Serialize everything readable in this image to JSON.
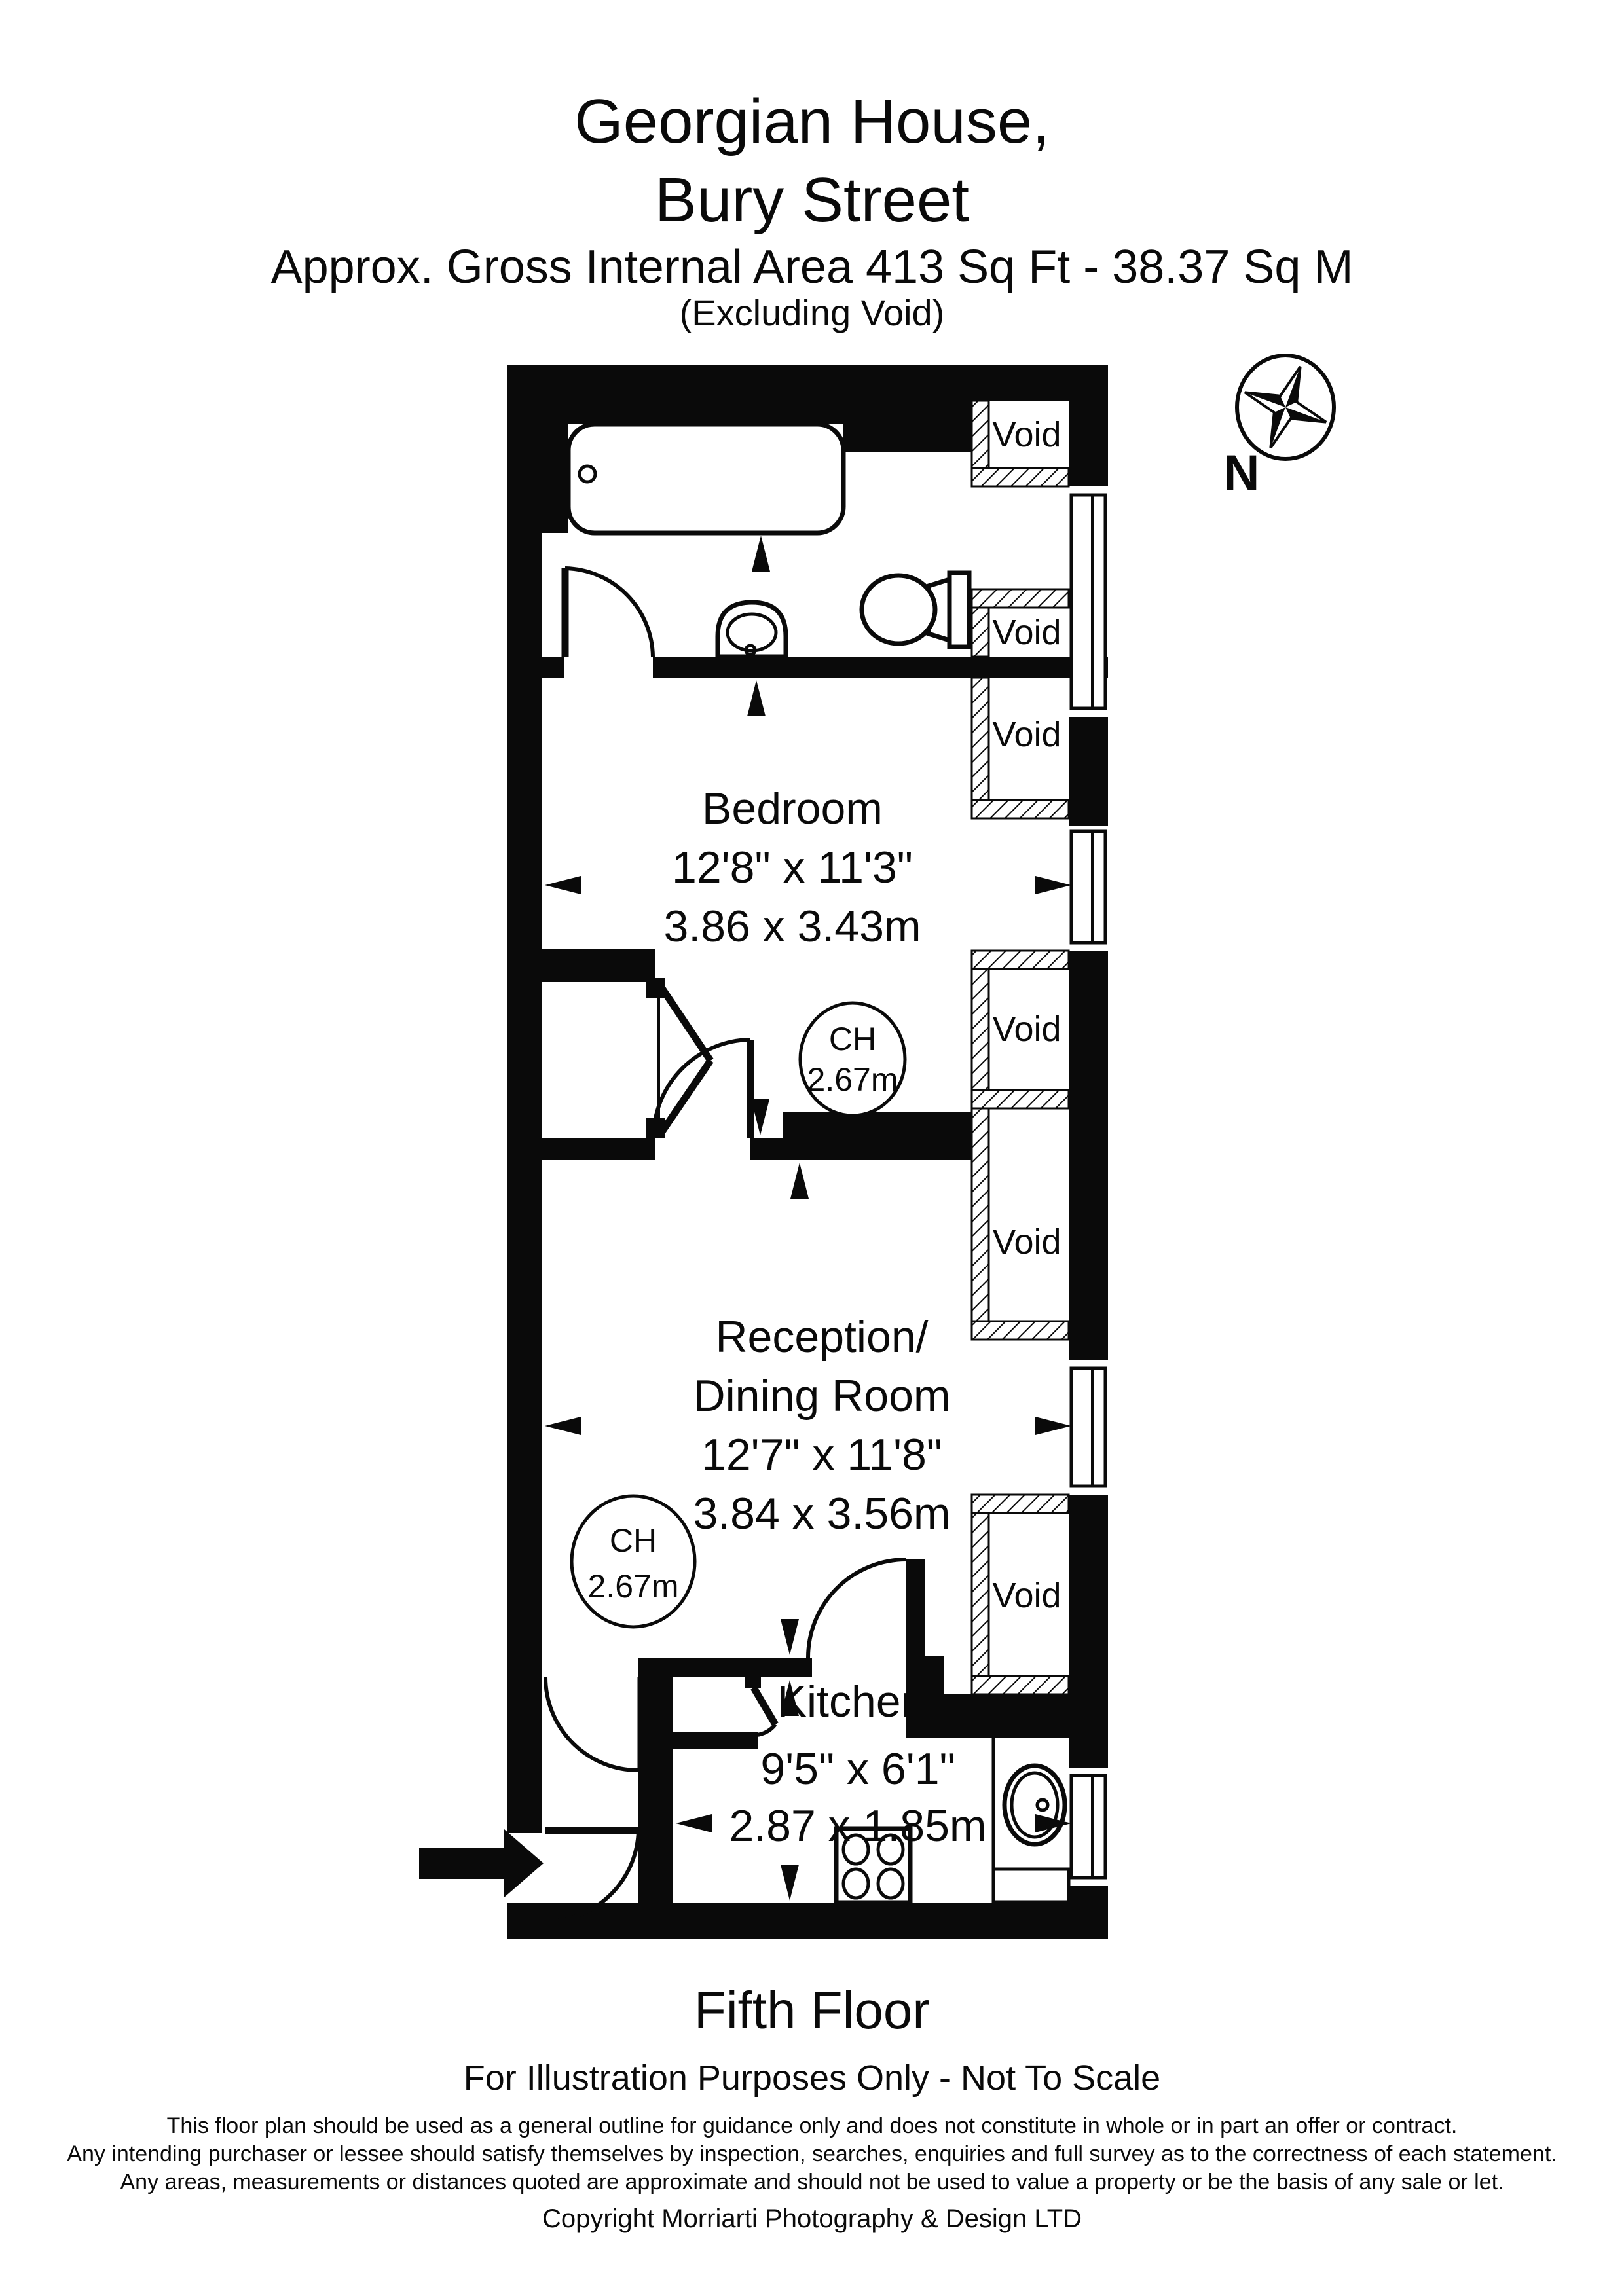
{
  "header": {
    "title_line1": "Georgian House,",
    "title_line2": "Bury Street",
    "area_line": "Approx. Gross Internal Area   413 Sq Ft  -  38.37 Sq M",
    "excluding_line": "(Excluding Void)"
  },
  "compass": {
    "north_label": "N"
  },
  "rooms": {
    "bedroom": {
      "name": "Bedroom",
      "dims_imperial": "12'8\" x 11'3\"",
      "dims_metric": "3.86 x 3.43m"
    },
    "reception": {
      "name_line1": "Reception/",
      "name_line2": "Dining Room",
      "dims_imperial": "12'7\" x 11'8\"",
      "dims_metric": "3.84 x 3.56m"
    },
    "kitchen": {
      "name": "Kitchen",
      "dims_imperial": "9'5\" x 6'1\"",
      "dims_metric": "2.87 x 1.85m"
    }
  },
  "ceiling_heights": [
    {
      "label": "CH",
      "value": "2.67m"
    },
    {
      "label": "CH",
      "value": "2.67m"
    }
  ],
  "voids": [
    "Void",
    "Void",
    "Void",
    "Void",
    "Void",
    "Void"
  ],
  "footer": {
    "floor": "Fifth Floor",
    "disclaimer_title": "For Illustration Purposes Only - Not To Scale",
    "disclaimer_line1": "This floor plan should be used as a general outline for guidance only and does not constitute in whole or in part an offer or contract.",
    "disclaimer_line2": "Any intending purchaser or lessee should satisfy themselves by inspection, searches, enquiries and full survey as to the correctness of each statement.",
    "disclaimer_line3": "Any areas, measurements or distances quoted are approximate and should not be used to value a property or be the basis of any sale or let.",
    "copyright": "Copyright Morriarti Photography & Design LTD"
  }
}
